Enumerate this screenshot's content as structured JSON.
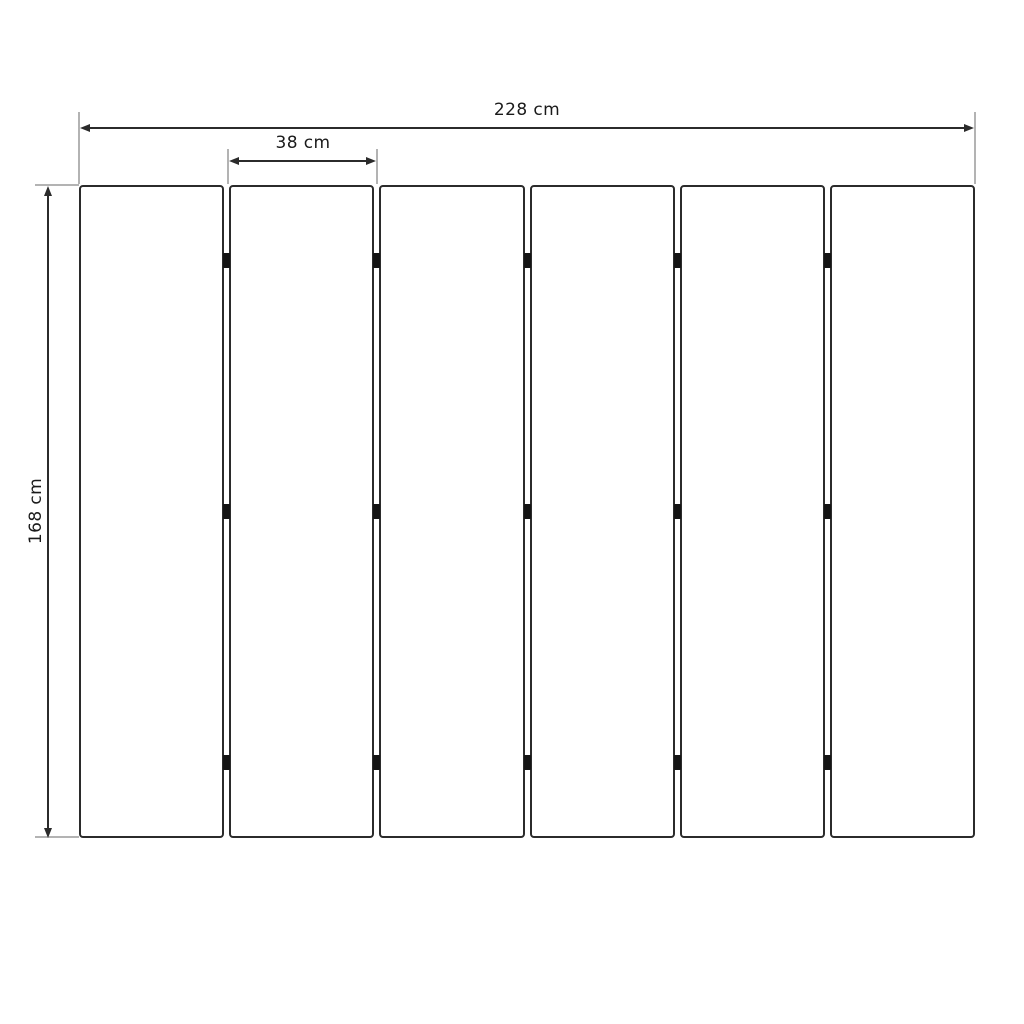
{
  "diagram": {
    "type": "technical-dimension-drawing",
    "panels": {
      "count": 6,
      "joints": 5,
      "hinges_per_joint": 3
    },
    "dimensions": {
      "total_width": {
        "label": "228 cm"
      },
      "single_panel_width": {
        "label": "38 cm"
      },
      "height": {
        "label": "168 cm"
      }
    },
    "colors": {
      "background": "#ffffff",
      "panel_outline": "#2b2b2b",
      "dimension_line": "#2b2b2b",
      "extension_line": "#b3b3b3",
      "hinge": "#141414",
      "label_text": "#1a1a1a"
    },
    "layout_hints": {
      "hinge_positions_fraction": [
        0.115,
        0.5,
        0.885
      ]
    }
  }
}
